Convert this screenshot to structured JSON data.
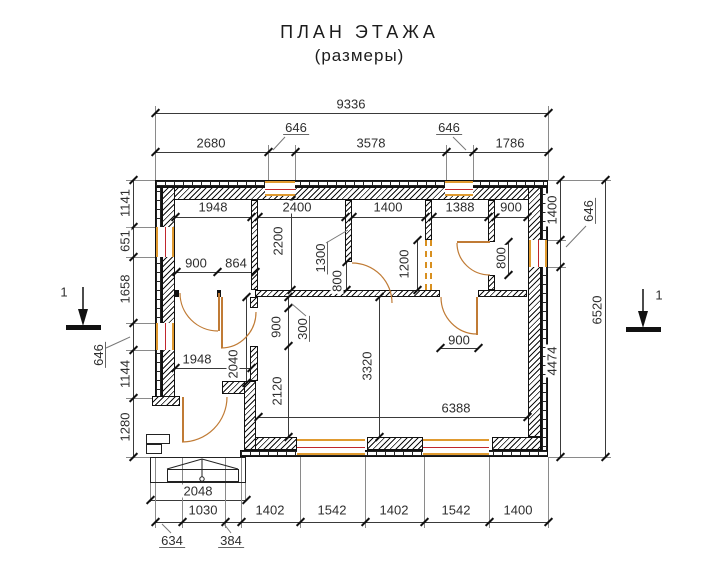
{
  "title": {
    "line1": "ПЛАН ЭТАЖА",
    "line2": "(размеры)"
  },
  "section_markers": {
    "left_label": "1",
    "right_label": "1"
  },
  "dimensions": {
    "top_overall": "9336",
    "top_chain": [
      "2680",
      "646",
      "3578",
      "646",
      "1786"
    ],
    "left_chain": [
      "1141",
      "651",
      "1658",
      "646",
      "1144",
      "1280"
    ],
    "right_chain": [
      "1400",
      "646",
      "4474"
    ],
    "right_overall": "6520",
    "bottom_chain": [
      "634",
      "1030",
      "384",
      "1402",
      "1542",
      "1402",
      "1542",
      "1400"
    ],
    "porch_width": "2048",
    "room_widths_top": [
      "1948",
      "2400",
      "1400",
      "1388",
      "900"
    ],
    "interior": {
      "hall_door_1": "900",
      "hall_door_2": "864",
      "room2_depth": "2200",
      "door_pos_1300": "1300",
      "door_b_800": "800",
      "opening_1200": "1200",
      "door_d_800": "800",
      "big_room_door_900": "900",
      "offset_300": "300",
      "opening_900": "900",
      "hall_depth_2040": "2040",
      "wall_2120": "2120",
      "hall_width_1948": "1948",
      "big_room_depth_3320": "3320",
      "big_room_width_6388": "6388"
    }
  },
  "colors": {
    "wall": "#111111",
    "window_frame": "#e09a2f",
    "window_core": "#c1272d",
    "door": "#c07b35",
    "dim_text": "#2e2e2e"
  }
}
